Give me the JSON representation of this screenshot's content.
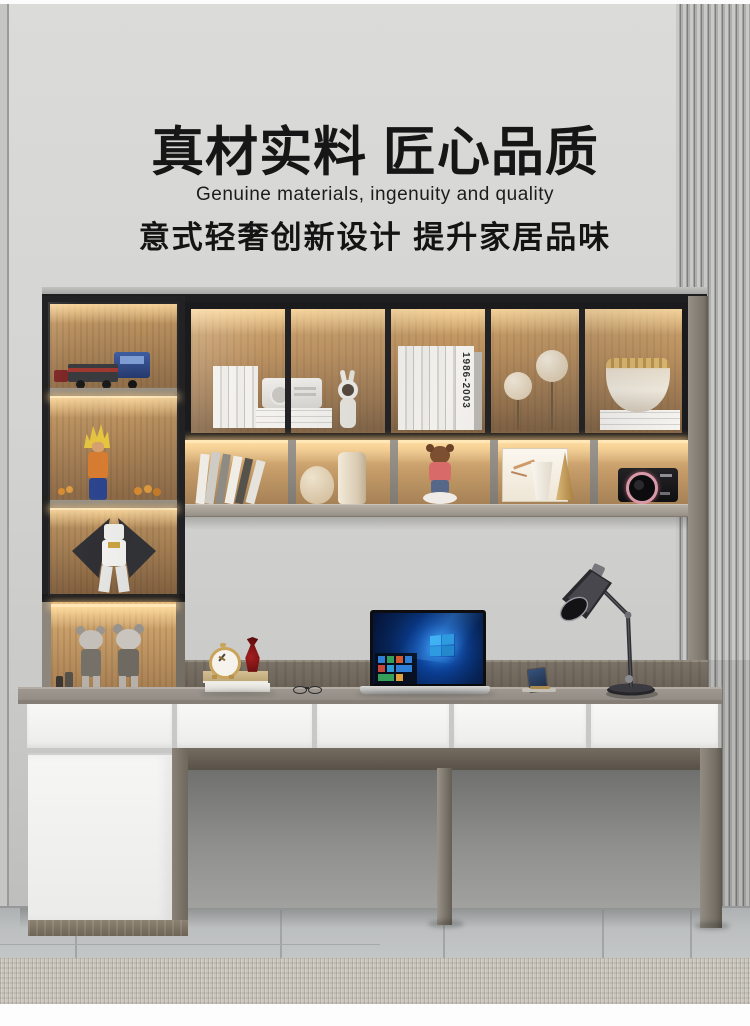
{
  "banner": {
    "title": "真材实料 匠心品质",
    "subtitle_en": "Genuine materials, ingenuity and quality",
    "subtitle_cn": "意式轻奢创新设计 提升家居品味"
  },
  "decor": {
    "book_spine_years": "1986-2003"
  },
  "palette": {
    "wall": "#d6d6d4",
    "slat_panel": "#b9b9b7",
    "cabinet_frame": "#202022",
    "cabinet_wood": "#b08556",
    "led_glow": "#ffd9a0",
    "desk_top": "#9d978f",
    "backsplash_wood": "#776f64",
    "drawer_front": "#f5f5f3",
    "plinth_wood": "#857a6a",
    "floor_tile": "#b9bcbd",
    "rug": "#cbc6be",
    "clock_gold": "#c9a45a",
    "vase_red": "#8c1616",
    "laptop_screen_blue": "#0a3a8c",
    "lamp_black": "#2a2a2c"
  }
}
